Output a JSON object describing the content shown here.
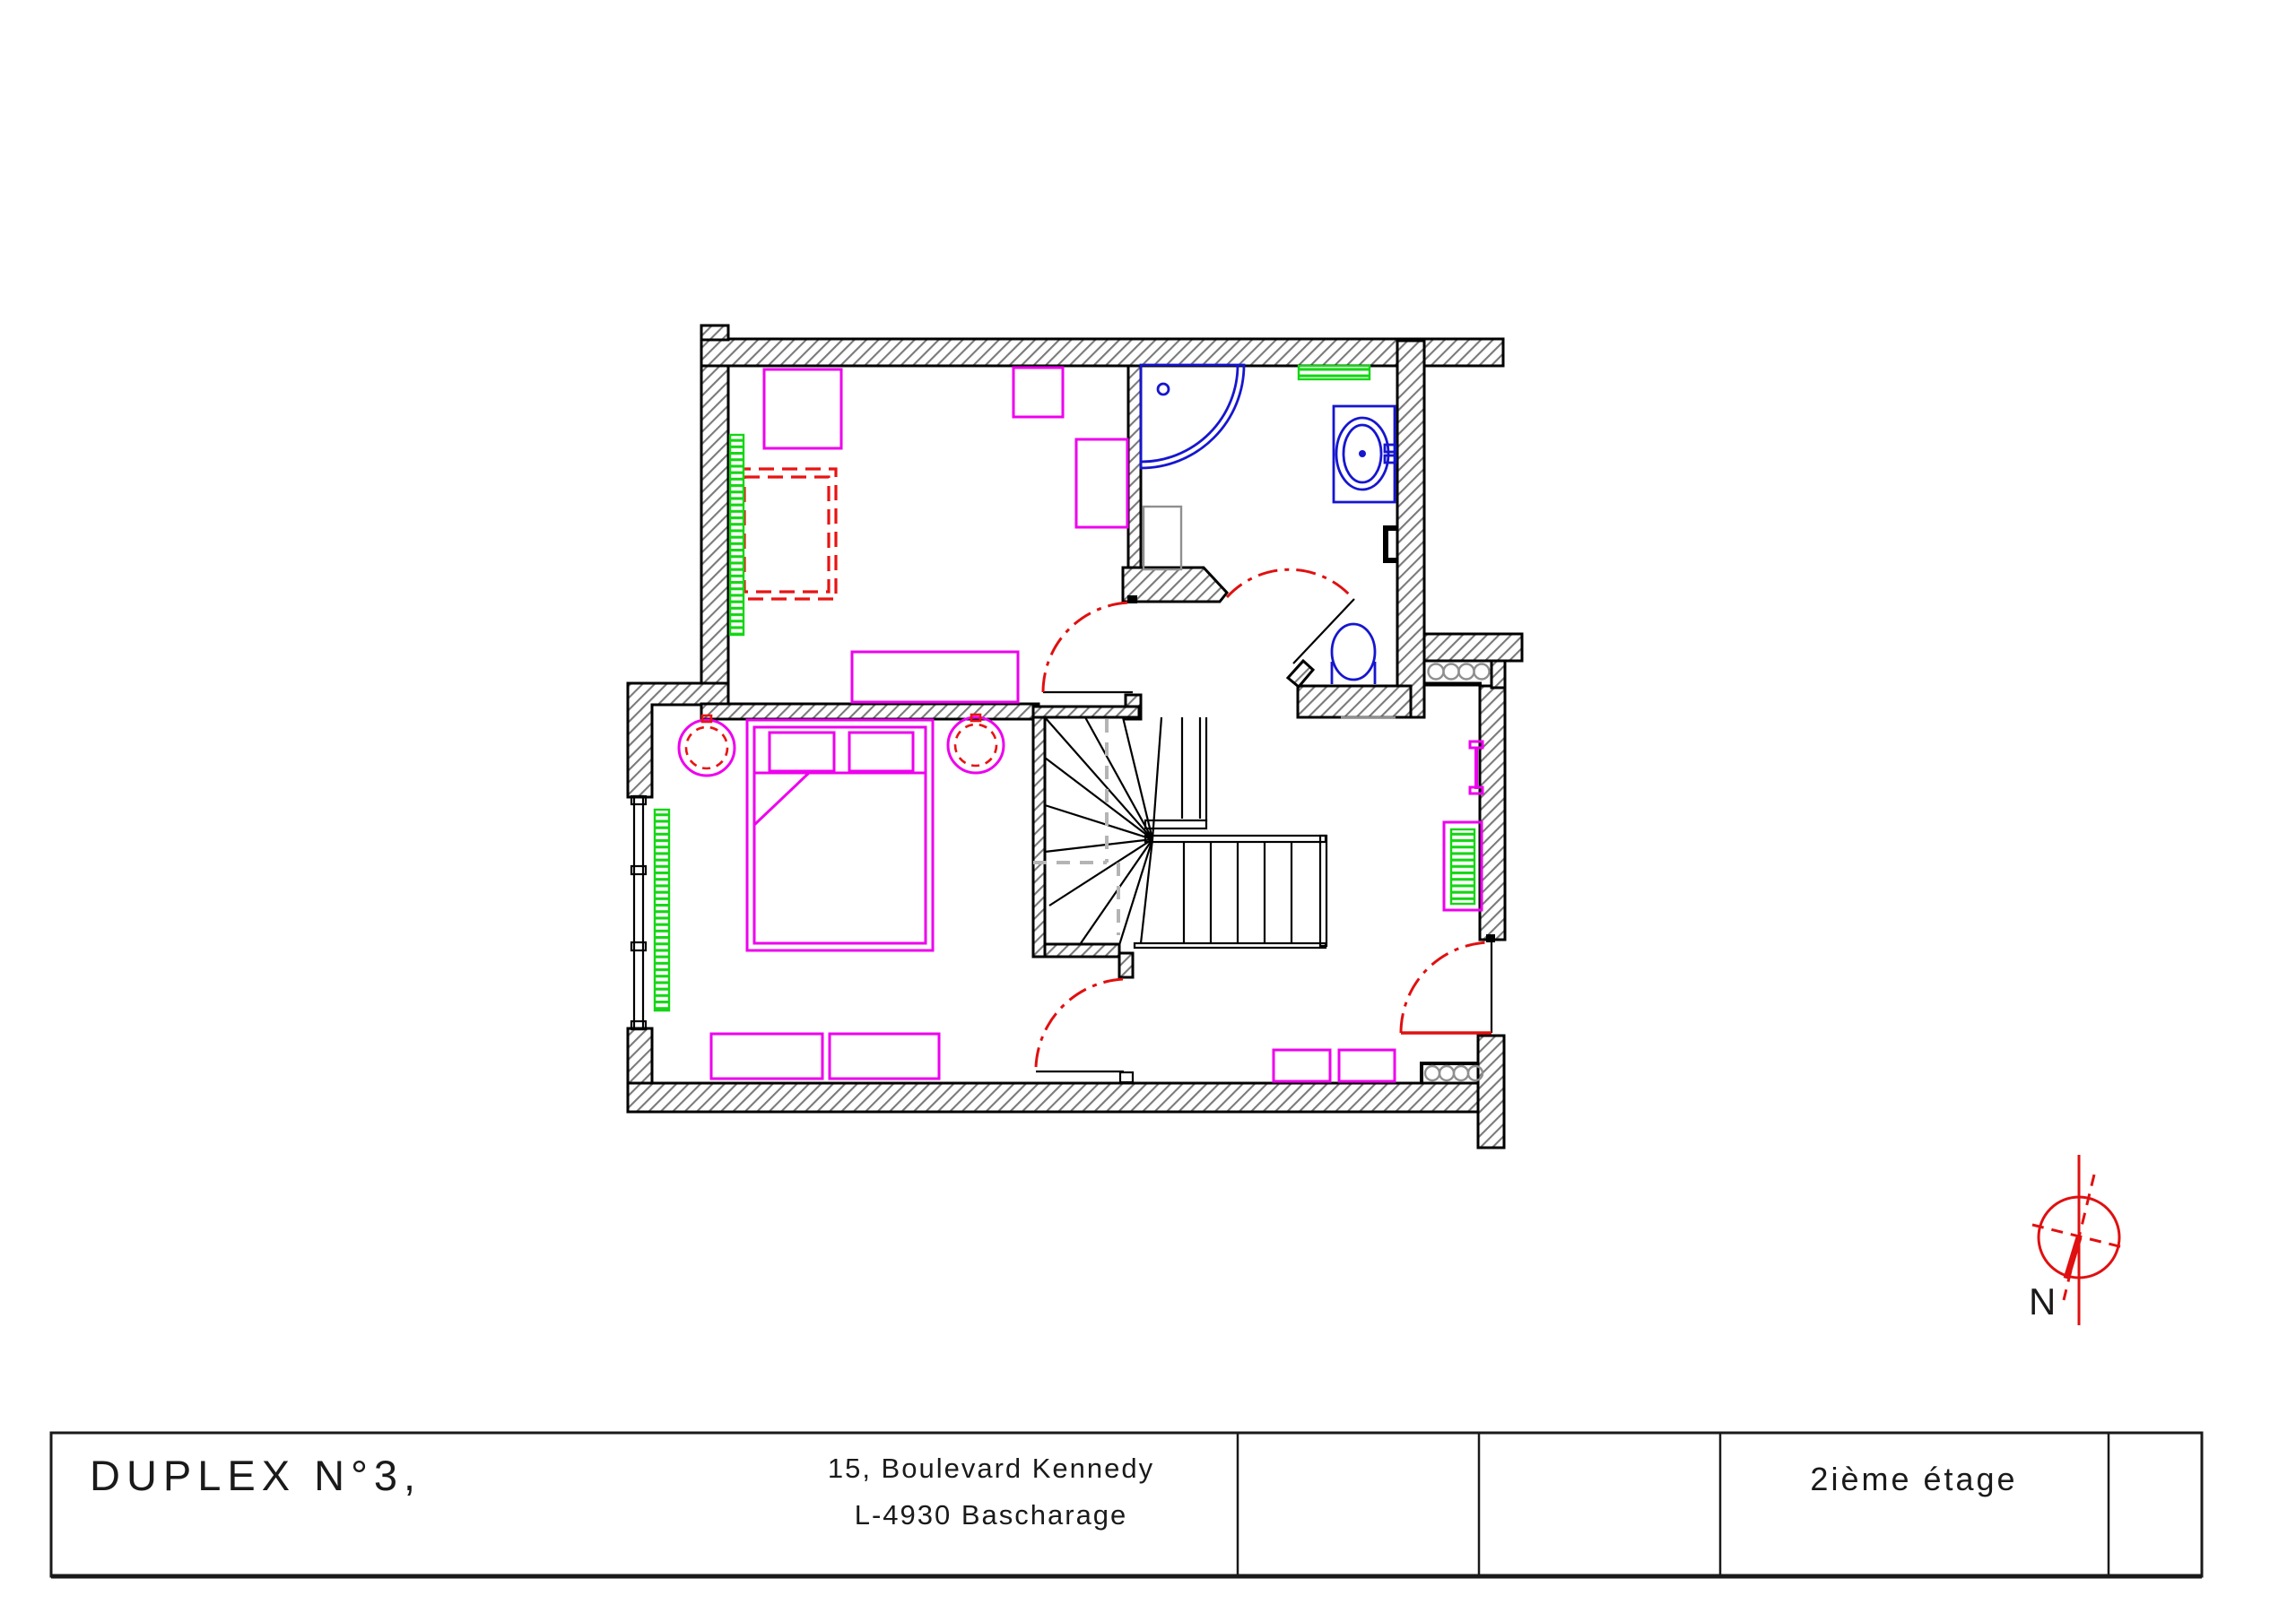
{
  "title_block": {
    "project_title": "DUPLEX N°3,",
    "address_line1": "15, Boulevard Kennedy",
    "address_line2": "L-4930 Bascharage",
    "floor_label": "2ième étage"
  },
  "compass": {
    "label": "N"
  },
  "colors": {
    "wall_outline": "#000000",
    "wall_hatch": "#7a7a7a",
    "furniture": "#ee00ee",
    "bed_dashed": "#e81313",
    "door_swing": "#e01010",
    "sanitary": "#1616cf",
    "radiator": "#14d614",
    "travel_line": "#b4b4b4",
    "compass": "#e01010"
  }
}
